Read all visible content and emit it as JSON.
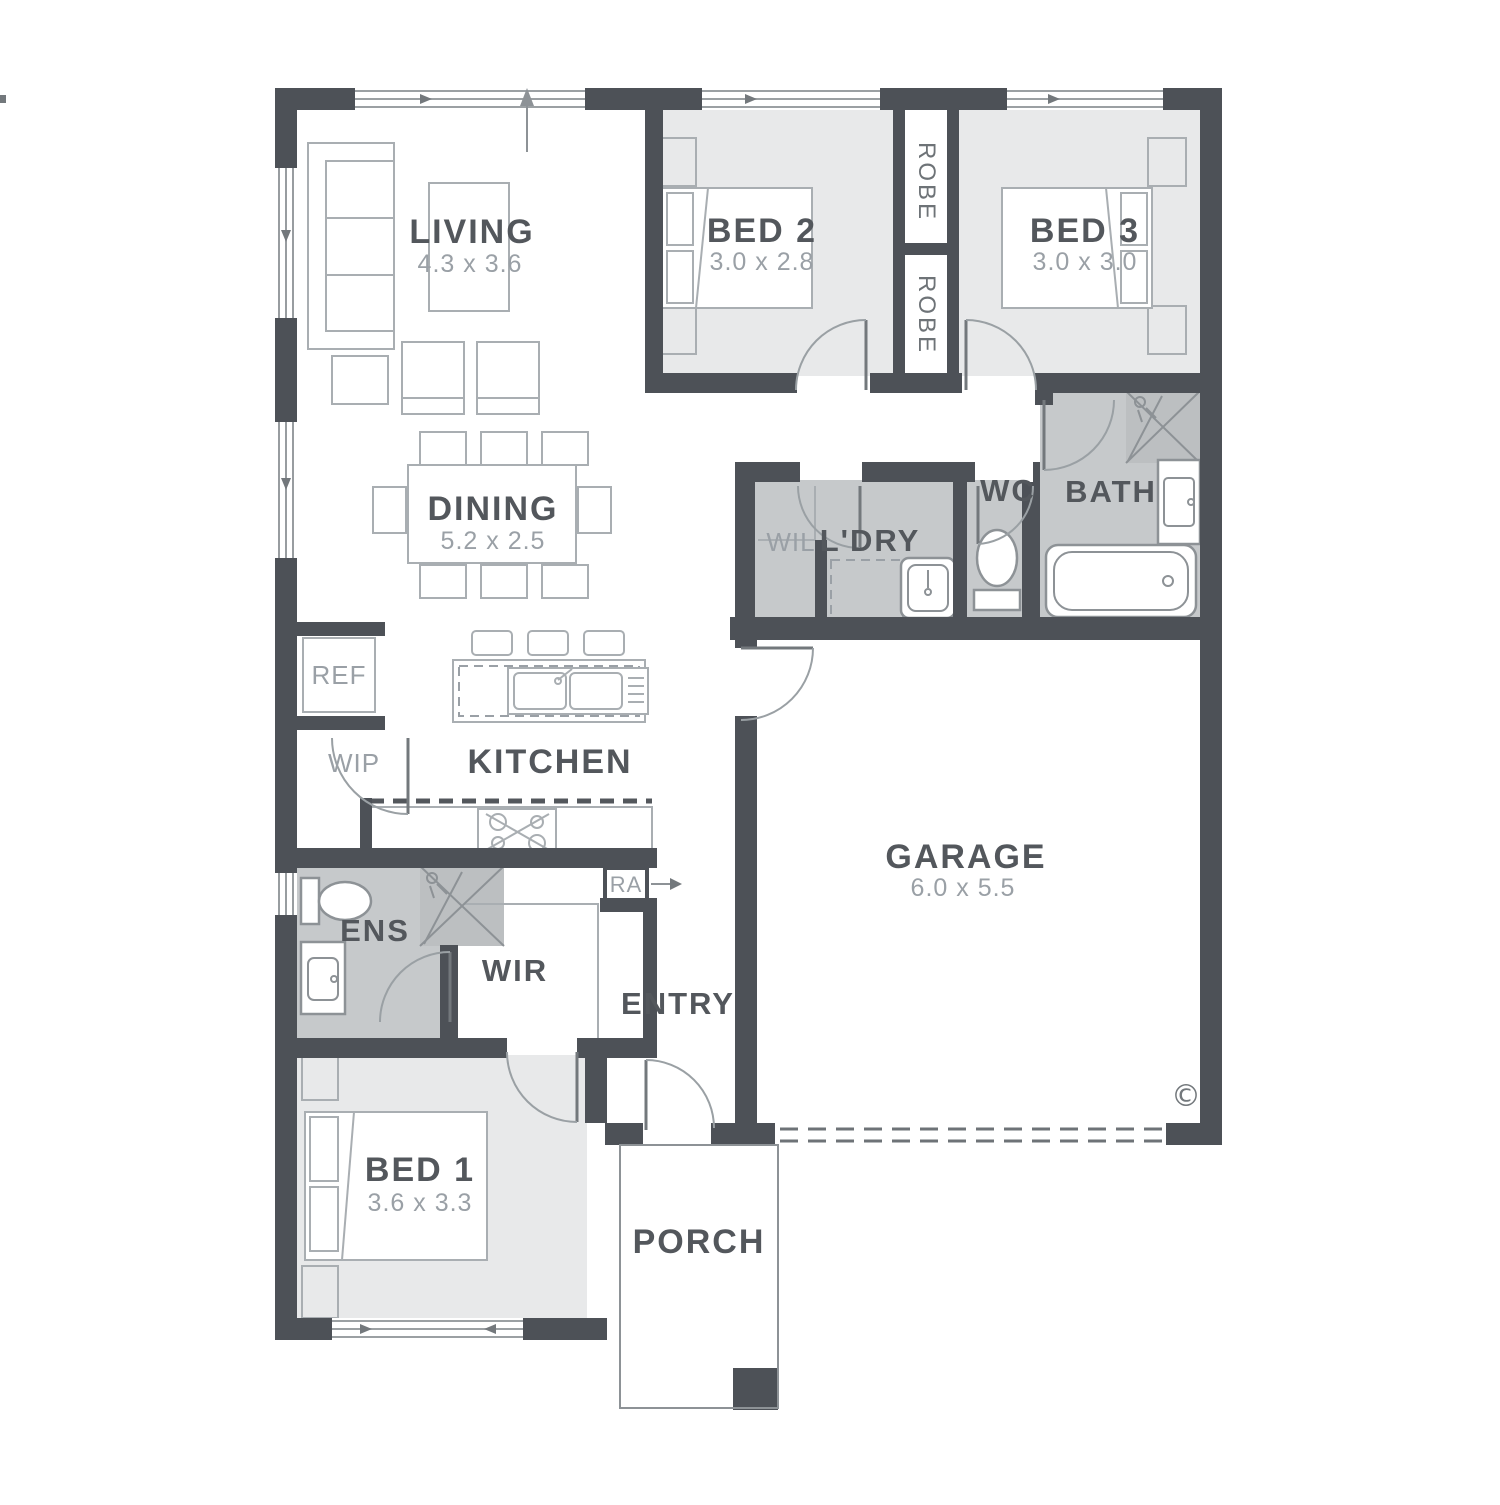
{
  "plan": {
    "rooms": {
      "living": {
        "name": "LIVING",
        "dims": "4.3 x 3.6"
      },
      "dining": {
        "name": "DINING",
        "dims": "5.2 x 2.5"
      },
      "kitchen": {
        "name": "KITCHEN"
      },
      "bed1": {
        "name": "BED 1",
        "dims": "3.6 x 3.3"
      },
      "bed2": {
        "name": "BED 2",
        "dims": "3.0 x 2.8"
      },
      "bed3": {
        "name": "BED 3",
        "dims": "3.0 x 3.0"
      },
      "garage": {
        "name": "GARAGE",
        "dims": "6.0 x 5.5"
      },
      "bath": {
        "name": "BATH"
      },
      "wc": {
        "name": "WC"
      },
      "laundry": {
        "name": "L'DRY"
      },
      "wil": {
        "name": "WIL"
      },
      "ens": {
        "name": "ENS"
      },
      "wir": {
        "name": "WIR"
      },
      "wip": {
        "name": "WIP"
      },
      "entry": {
        "name": "ENTRY"
      },
      "porch": {
        "name": "PORCH"
      },
      "robe1": {
        "name": "ROBE"
      },
      "robe2": {
        "name": "ROBE"
      }
    },
    "fixtures": {
      "ref_label": "REF",
      "ra_label": "RA"
    },
    "symbols": {
      "copyright": "©"
    },
    "colors": {
      "wall": "#4d5157",
      "wet_area": "#c6c9cb",
      "shower": "#bcbfc1",
      "bedroom_fill": "#e8e9ea",
      "furniture_line": "#a9aeb2",
      "label_text": "#53575c",
      "dim_text": "#9aa0a6"
    }
  }
}
